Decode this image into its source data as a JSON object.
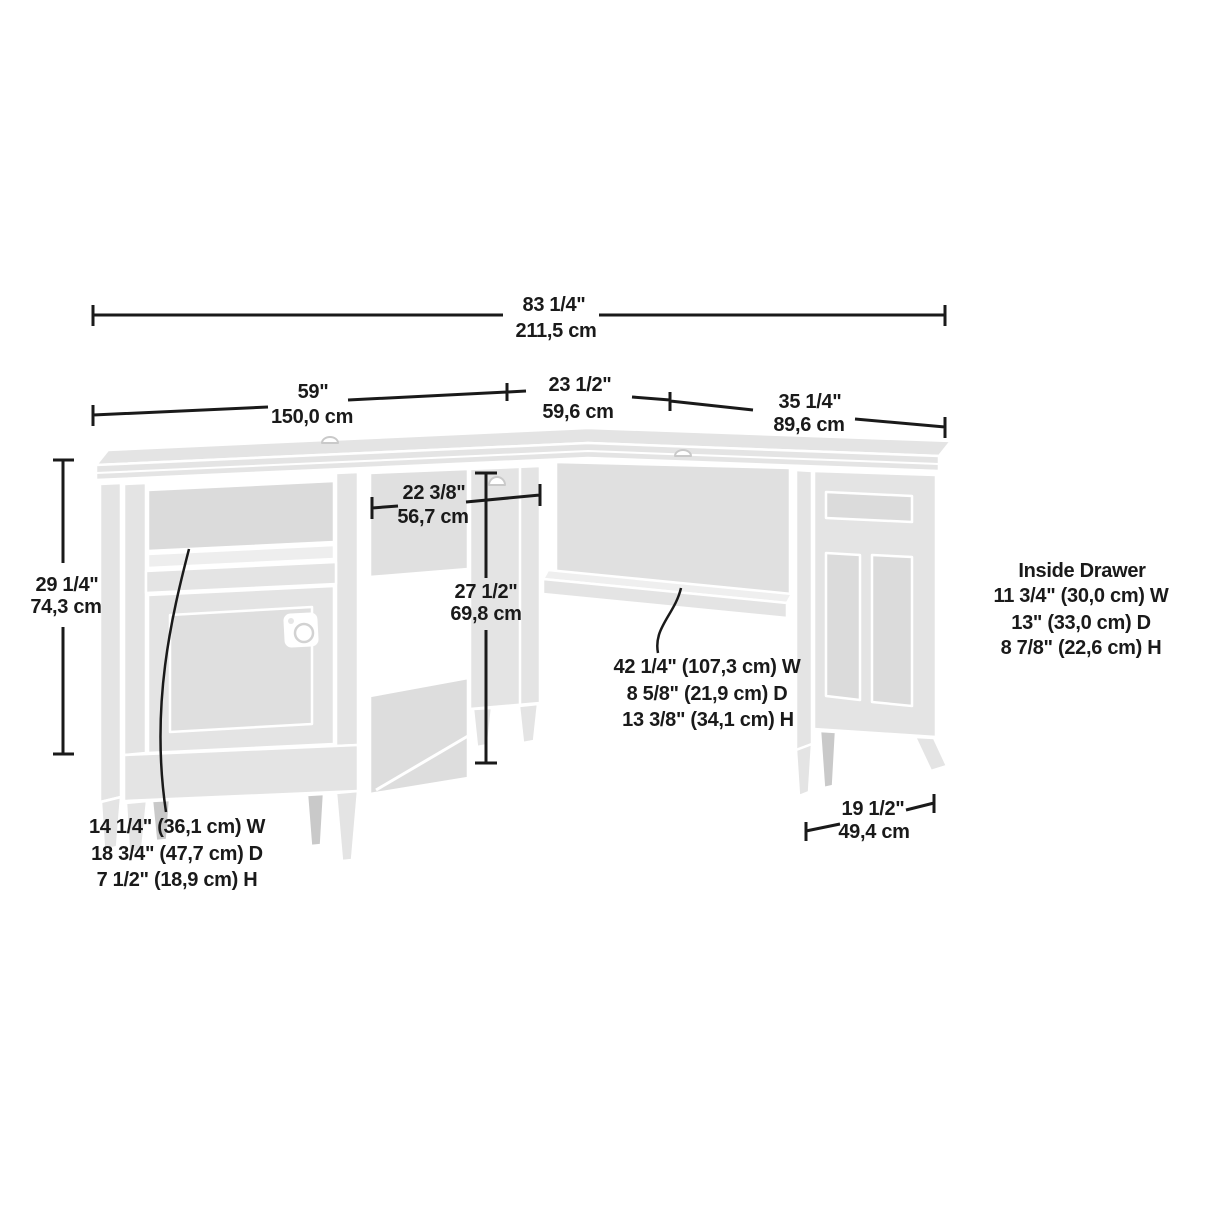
{
  "colors": {
    "dimension_line": "#1a1a1a",
    "text": "#1a1a1a",
    "desk_fill": "#e4e4e4",
    "desk_recess": "#dbdbdb",
    "desk_shadow_leg": "#c9c9c9",
    "background": "#ffffff"
  },
  "dims": {
    "overall": {
      "in": "83 1/4\"",
      "cm": "211,5 cm"
    },
    "main": {
      "in": "59\"",
      "cm": "150,0 cm"
    },
    "corner": {
      "in": "23 1/2\"",
      "cm": "59,6 cm"
    },
    "return_width": {
      "in": "35 1/4\"",
      "cm": "89,6 cm"
    },
    "height": {
      "in": "29 1/4\"",
      "cm": "74,3 cm"
    },
    "knee": {
      "in": "22 3/8\"",
      "cm": "56,7 cm"
    },
    "clearance": {
      "in": "27 1/2\"",
      "cm": "69,8 cm"
    },
    "return_depth": {
      "in": "19 1/2\"",
      "cm": "49,4 cm"
    }
  },
  "notes": {
    "cubby": [
      "14 1/4\" (36,1 cm) W",
      "18 3/4\" (47,7 cm) D",
      "7 1/2\" (18,9 cm) H"
    ],
    "shelf": [
      "42 1/4\" (107,3 cm) W",
      "8 5/8\" (21,9 cm) D",
      "13 3/8\" (34,1 cm) H"
    ],
    "inside_drawer": {
      "title": "Inside Drawer",
      "lines": [
        "11 3/4\" (30,0 cm) W",
        "13\" (33,0 cm) D",
        "8 7/8\" (22,6 cm) H"
      ]
    }
  }
}
